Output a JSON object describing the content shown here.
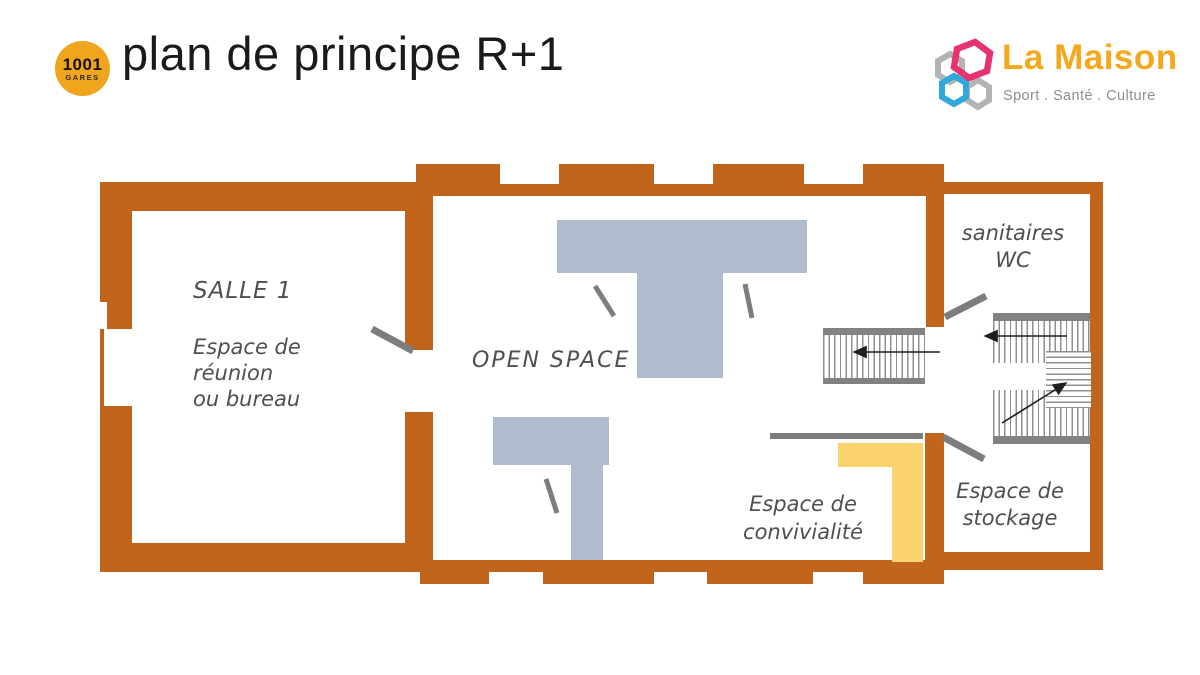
{
  "header": {
    "title": "plan de principe R+1",
    "badge": {
      "line1": "1001",
      "line2": "GARES"
    },
    "brand": {
      "name": "La Maison",
      "tagline": "Sport . Santé . Culture"
    }
  },
  "plan": {
    "rooms": {
      "salle1": {
        "name": "SALLE 1",
        "desc": [
          "Espace de",
          "réunion",
          "ou bureau"
        ]
      },
      "open_space": {
        "name": "OPEN SPACE"
      },
      "sanitaires": {
        "line1": "sanitaires",
        "line2": "WC"
      },
      "stockage": {
        "line1": "Espace de",
        "line2": "stockage"
      },
      "convivialite": {
        "line1": "Espace de",
        "line2": "convivialité"
      }
    },
    "colors": {
      "wall": "#c2651c",
      "furniture": "#afbcce",
      "highlight": "#fad36e",
      "door_swing": "#7d7d7d",
      "stair_band": "#828282",
      "arrow": "#1f1f1f",
      "badge": "#f0a51f",
      "brand_orange": "#f6a81c",
      "brand_pink": "#e6326e",
      "brand_cyan": "#2fa8dc",
      "brand_gray": "#b3b3b6"
    }
  }
}
